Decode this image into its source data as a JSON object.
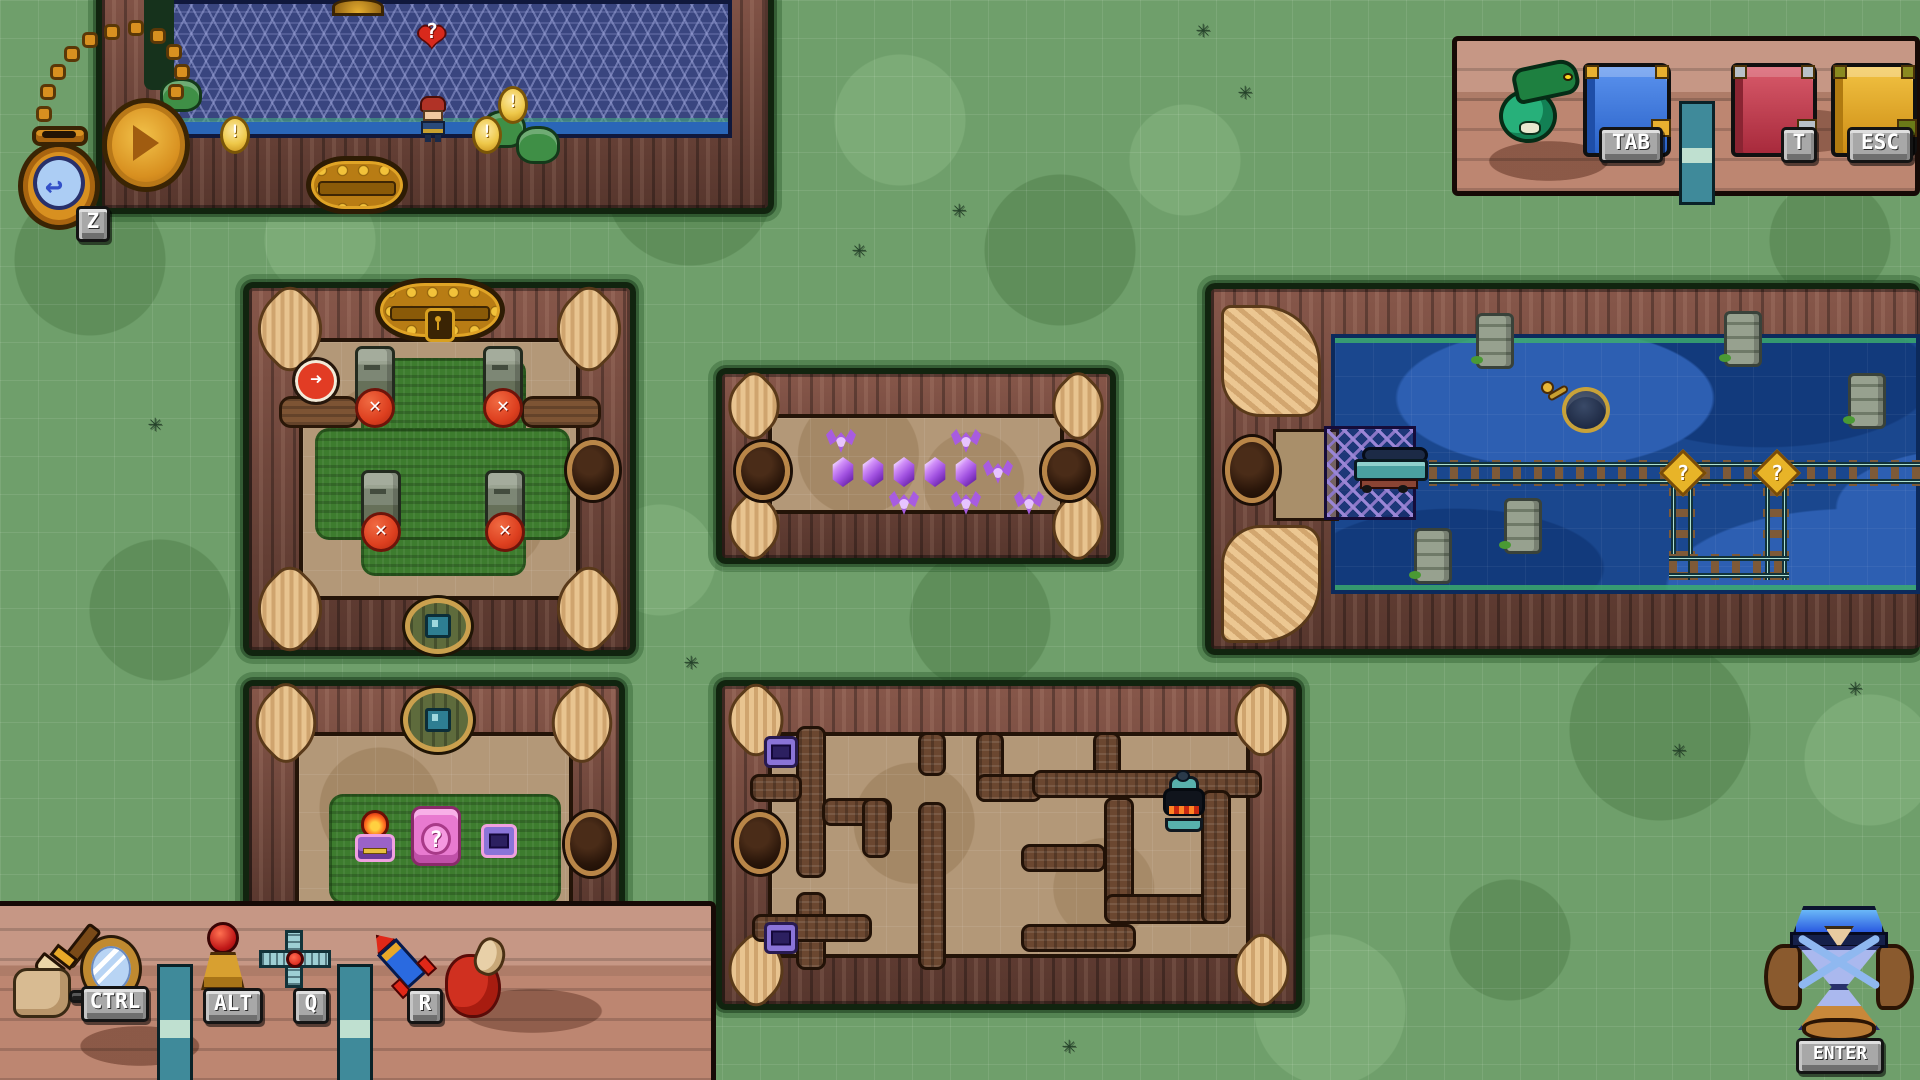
{
  "hud": {
    "watch_key": "Z",
    "hourglass_key": "ENTER"
  },
  "top_shelf": {
    "dragon_key": "",
    "blue_book_key": "TAB",
    "red_book_key": "T",
    "gold_book_key": "ESC"
  },
  "bottom_shelf": {
    "brush_key": "",
    "mirror_key": "CTRL",
    "scepter_key": "ALT",
    "hook_key": "Q",
    "rocket_key": "R"
  },
  "markers": {
    "question": "?",
    "exclamation": "!",
    "cross": "✕",
    "arrow": "➜"
  }
}
